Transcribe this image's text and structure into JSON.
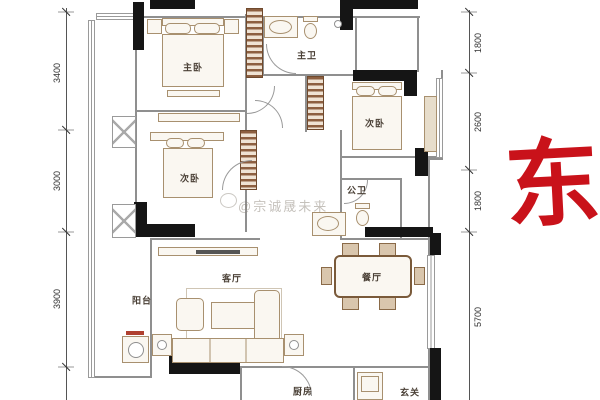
{
  "compass": {
    "east_label": "东",
    "color": "#c9121a"
  },
  "watermark": {
    "text": "@宗诚晟未来"
  },
  "rooms": {
    "master_bedroom": {
      "label": "主卧"
    },
    "master_bath": {
      "label": "主卫"
    },
    "bedroom_right": {
      "label": "次卧"
    },
    "bedroom_left": {
      "label": "次卧"
    },
    "public_bath": {
      "label": "公卫"
    },
    "living_room": {
      "label": "客厅"
    },
    "dining_room": {
      "label": "餐厅"
    },
    "balcony": {
      "label": "阳台"
    },
    "kitchen": {
      "label": "厨房"
    },
    "entry": {
      "label": "玄关"
    }
  },
  "dimensions": {
    "left": [
      "3400",
      "3000",
      "3900"
    ],
    "right": [
      "1800",
      "2600",
      "1800",
      "5700"
    ]
  },
  "colors": {
    "wall_black": "#151515",
    "wall_gray": "#8f8f8f",
    "closet_hatch": "#8d5f40",
    "furniture_line": "#a8906f",
    "compass_red": "#c9121a"
  }
}
